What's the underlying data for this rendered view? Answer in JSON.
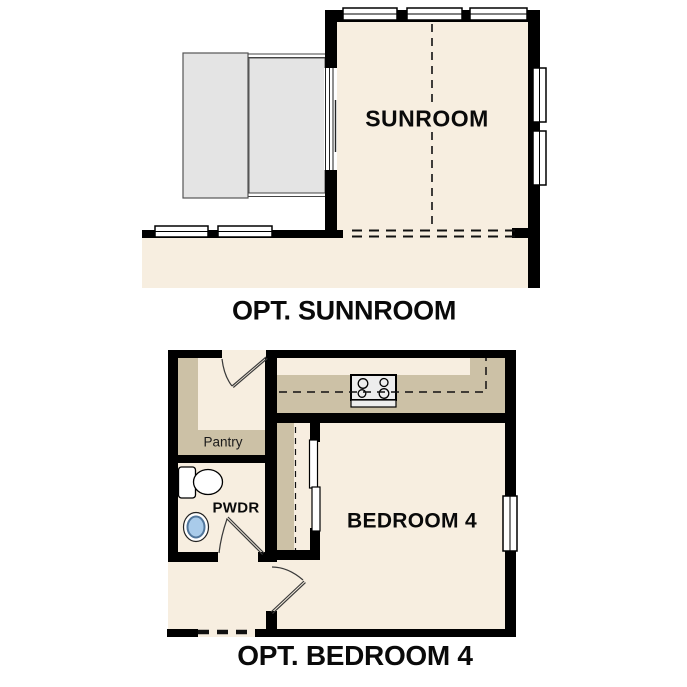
{
  "colors": {
    "wall": "#000000",
    "floor_cream": "#f7eee0",
    "cabinet_tan": "#ccc1a6",
    "patio_gray": "#e4e4e4",
    "appliance_gray": "#ededed",
    "window_white": "#ffffff",
    "sink_blue": "#a9cbea",
    "line_dark": "#444444"
  },
  "sunroom_plan": {
    "room_label": "SUNROOM",
    "caption": "OPT. SUNNROOM"
  },
  "bedroom_plan": {
    "room_label": "BEDROOM 4",
    "caption": "OPT. BEDROOM 4",
    "pantry_label": "Pantry",
    "powder_label": "PWDR"
  },
  "icons": {
    "toilet": "toilet-icon",
    "sink": "sink-icon",
    "cooktop": "cooktop-icon",
    "door_swing": "door-swing-icon",
    "window": "window-icon"
  }
}
